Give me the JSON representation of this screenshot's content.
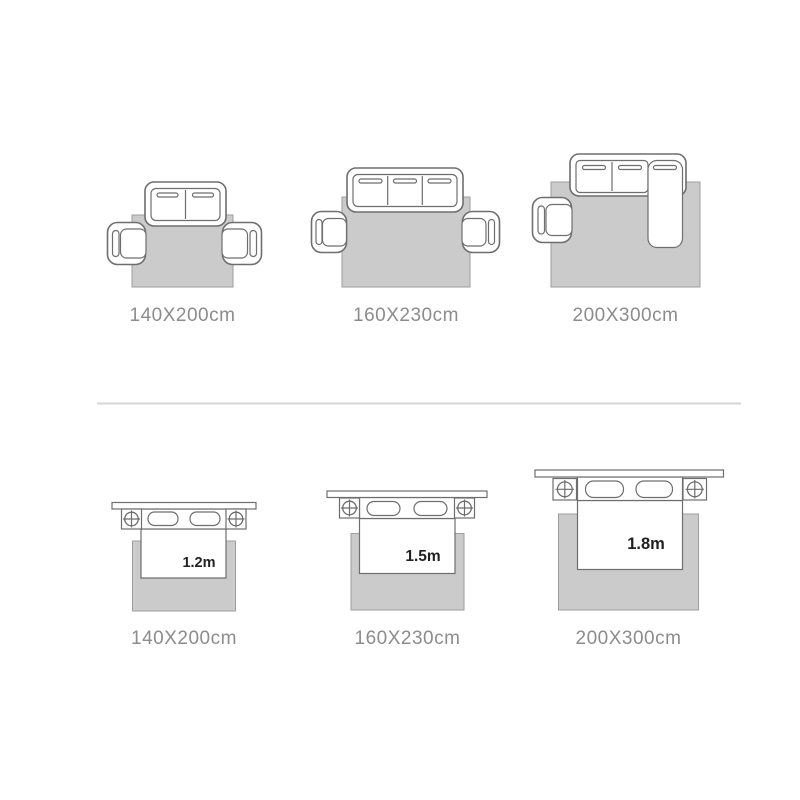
{
  "colors": {
    "background": "#ffffff",
    "rug-fill": "#cbcbcb",
    "rug-stroke": "#9e9e9e",
    "furniture-stroke": "#6e6e6e",
    "furniture-fill": "#ffffff",
    "bed-size-text": "#222222",
    "label-text": "#8c8c8c",
    "divider": "#d6d6d6"
  },
  "living_room": {
    "layouts": [
      {
        "rug_size": "140X200cm",
        "furniture": "two-seat sofa with two armchairs"
      },
      {
        "rug_size": "160X230cm",
        "furniture": "three-seat sofa with two armchairs"
      },
      {
        "rug_size": "200X300cm",
        "furniture": "sectional chaise sofa with one armchair"
      }
    ]
  },
  "bedroom": {
    "layouts": [
      {
        "rug_size": "140X200cm",
        "bed_width": "1.2m"
      },
      {
        "rug_size": "160X230cm",
        "bed_width": "1.5m"
      },
      {
        "rug_size": "200X300cm",
        "bed_width": "1.8m"
      }
    ]
  }
}
